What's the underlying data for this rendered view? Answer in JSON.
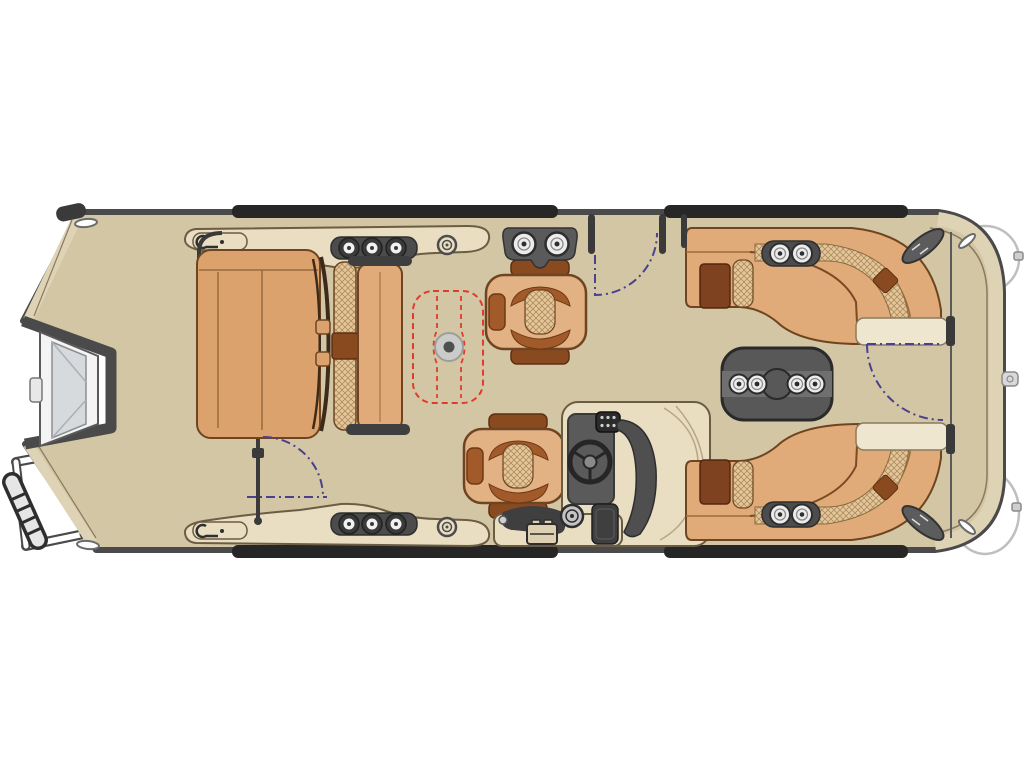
{
  "page": {
    "background": "#ffffff",
    "title": "Pontoon boat floor plan — top-down view, bow right, stern left"
  },
  "colors": {
    "deck": "#d3c6a4",
    "deck_rim": "#dfd3b6",
    "rim_seam": "#8a7a5f",
    "hull_outline": "#4a4a4a",
    "rail_black": "#262626",
    "panel": "#e9ddc2",
    "panel_edge": "#6b5c44",
    "seat_tan": "#e2b184",
    "seat_mid": "#dca26e",
    "seat_light": "#e0ab79",
    "seat_edge": "#6e4520",
    "seat_brown": "#a35a2a",
    "seat_dark_brown": "#7e4220",
    "accent_brown": "#8a4a1f",
    "crosshatch_base": "#e3c79b",
    "crosshatch_line": "#b08b5c",
    "console_gray": "#5a5a5a",
    "equipment_dark": "#3f3f3f",
    "table_gray": "#585858",
    "table_band": "#6f6f6f",
    "cup_white": "#ececec",
    "pedestal_gray": "#cbcbc9",
    "option_red": "#e03c2d",
    "gate_arc_purple": "#4a4090",
    "motor_light": "#f4f4f4",
    "motor_inner": "#d7dadd",
    "end_cap": "#efe6cf",
    "white": "#ffffff"
  },
  "components": {
    "hull": {
      "shape": "pontoon",
      "bow": "right",
      "stern": "left",
      "side_gates": 2,
      "bow_gate": 1,
      "deck_vents": 4
    },
    "stern": {
      "outboard_motor": 1,
      "boarding_ladder": 1
    },
    "aft_panels": {
      "speakers_per_side": 3,
      "courtesy_light_per_side": 1,
      "cleat_per_side": 1
    },
    "seating": {
      "aft_back_to_back_lounge": 1,
      "companion_swivel_chair": 1,
      "helm_swivel_chair": 1,
      "bow_wraparound_lounges": 2
    },
    "tables": {
      "bow_table_cupholders": 4,
      "rail_caddy_cupholders": 2,
      "lounge_cupholders_per_side": 2,
      "optional_table_location": "midship pedestal base"
    },
    "helm": {
      "steering_wheel": 1,
      "keypad_buttons": 6,
      "windshield": 1,
      "battery_box": 1,
      "gauge": 1,
      "storage_box": 1
    }
  }
}
